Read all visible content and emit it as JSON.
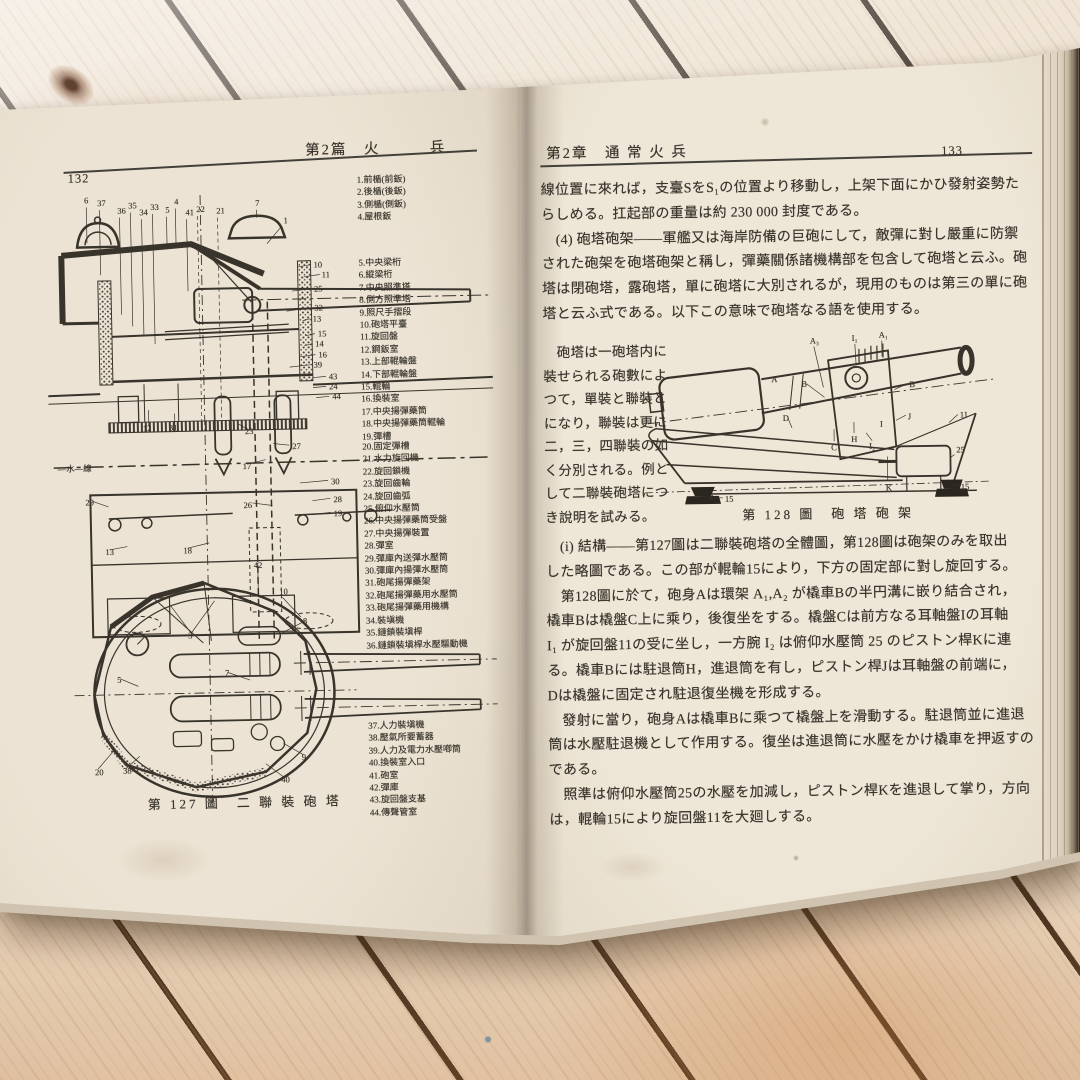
{
  "scene": {
    "description": "Open vintage Japanese gunnery textbook photographed on pale wooden planks",
    "colors": {
      "paper": "#eae1d2",
      "ink": "#38332b",
      "wood": "#ecdfcd",
      "plank_gap": "#33261b",
      "page_edge_dark": "#26201a"
    }
  },
  "book": {
    "left_page": {
      "page_number": "132",
      "running_head": "第2篇　火　　　兵",
      "figure_caption": "第 127 圖　二 聯 裝 砲 塔",
      "parts_list_1": [
        "1.前楯(前鈑)",
        "2.後楯(後鈑)",
        "3.側楯(側鈑)",
        "4.屋根鈑"
      ],
      "parts_list_2": [
        "5.中央梁桁",
        "6.縱梁桁",
        "7.中央照準塔",
        "8.側方照準塔",
        "9.照尺手摺段",
        "10.砲塔平臺",
        "11.旋回盤",
        "12.鋼鈑室",
        "13.上部輥輪盤",
        "14.下部輥輪盤",
        "15.輥輪",
        "16.換裝室",
        "17.中央揚彈藥筒",
        "18.中央揚彈藥筒輥輪",
        "19.彈槽"
      ],
      "parts_list_3": [
        "20.固定彈槽",
        "21.水力旋回機",
        "22.旋回鎖機",
        "23.旋回齒輪",
        "24.旋回齒弧",
        "25.俯仰水壓筒",
        "26.中央揚彈藥筒受盤",
        "27.中央揚彈裝置",
        "28.彈室",
        "29.彈庫內送彈水壓筒",
        "30.彈庫內揚彈水壓筒",
        "31.砲尾揚彈藥架",
        "32.砲尾揚彈藥用水壓筒",
        "33.砲尾揚彈藥用機構",
        "34.裝塡機",
        "35.鏈鎖裝塡桿",
        "36.鏈鎖裝塡桿水壓驅動機"
      ],
      "parts_list_4": [
        "37.人力裝塡機",
        "38.壓氣所要蓄器",
        "39.人力及電力水壓喞筒",
        "40.換裝室入口",
        "41.砲室",
        "42.彈庫",
        "43.旋回盤支基",
        "44.傳聲管室"
      ],
      "fig127_labels": [
        {
          "x": 40,
          "y": 28,
          "t": "6"
        },
        {
          "x": 53,
          "y": 31,
          "t": "37"
        },
        {
          "x": 73,
          "y": 39,
          "t": "36"
        },
        {
          "x": 84,
          "y": 34,
          "t": "35"
        },
        {
          "x": 95,
          "y": 41,
          "t": "34"
        },
        {
          "x": 106,
          "y": 36,
          "t": "33"
        },
        {
          "x": 121,
          "y": 39,
          "t": "5"
        },
        {
          "x": 130,
          "y": 31,
          "t": "4"
        },
        {
          "x": 141,
          "y": 42,
          "t": "41"
        },
        {
          "x": 152,
          "y": 39,
          "t": "22"
        },
        {
          "x": 172,
          "y": 41,
          "t": "21"
        },
        {
          "x": 211,
          "y": 34,
          "t": "7"
        },
        {
          "x": 239,
          "y": 52,
          "t": "1"
        },
        {
          "x": 268,
          "y": 97,
          "t": "10"
        },
        {
          "x": 276,
          "y": 107,
          "t": "11"
        },
        {
          "x": 268,
          "y": 121,
          "t": "25"
        },
        {
          "x": 268,
          "y": 140,
          "t": "32"
        },
        {
          "x": 266,
          "y": 151,
          "t": "13"
        },
        {
          "x": 271,
          "y": 166,
          "t": "15"
        },
        {
          "x": 268,
          "y": 176,
          "t": "14"
        },
        {
          "x": 271,
          "y": 187,
          "t": "16"
        },
        {
          "x": 266,
          "y": 197,
          "t": "39"
        },
        {
          "x": 281,
          "y": 209,
          "t": "43"
        },
        {
          "x": 281,
          "y": 219,
          "t": "24"
        },
        {
          "x": 284,
          "y": 229,
          "t": "44"
        },
        {
          "x": 94,
          "y": 257,
          "t": "12"
        },
        {
          "x": 120,
          "y": 257,
          "t": "31"
        },
        {
          "x": 196,
          "y": 262,
          "t": "23"
        },
        {
          "x": 243,
          "y": 278,
          "t": "27"
        },
        {
          "x": 193,
          "y": 297,
          "t": "17"
        },
        {
          "x": 35,
          "y": 330,
          "t": "29"
        },
        {
          "x": 281,
          "y": 314,
          "t": "30"
        },
        {
          "x": 283,
          "y": 332,
          "t": "28"
        },
        {
          "x": 193,
          "y": 336,
          "t": "26"
        },
        {
          "x": 283,
          "y": 346,
          "t": "19"
        },
        {
          "x": 132,
          "y": 380,
          "t": "18"
        },
        {
          "x": 54,
          "y": 380,
          "t": "13"
        },
        {
          "x": 202,
          "y": 396,
          "t": "42"
        },
        {
          "x": 8,
          "y": 296,
          "t": "―水―線",
          "s": 13
        },
        {
          "x": 227,
          "y": 423,
          "t": "10"
        },
        {
          "x": 250,
          "y": 453,
          "t": "8"
        },
        {
          "x": 135,
          "y": 465,
          "t": "3"
        },
        {
          "x": 171,
          "y": 503,
          "t": "7"
        },
        {
          "x": 63,
          "y": 508,
          "t": "5"
        },
        {
          "x": 39,
          "y": 600,
          "t": "20"
        },
        {
          "x": 67,
          "y": 599,
          "t": "38"
        },
        {
          "x": 246,
          "y": 589,
          "t": "9"
        },
        {
          "x": 225,
          "y": 611,
          "t": "40"
        }
      ]
    },
    "right_page": {
      "page_number": "133",
      "running_head": "第2章　通 常 火 兵",
      "paragraphs_top": [
        "線位置に來れば，支臺SをS₁の位置より移動し，上架下面にかひ發射姿勢た",
        "らしめる。扛起部の重量は約 230 000 封度である。",
        "　(4) 砲塔砲架――軍艦又は海岸防備の巨砲にして，敵彈に對し嚴重に防禦",
        "された砲架を砲塔砲架と稱し，彈藥關係諸機構部を包含して砲塔と云ふ。砲",
        "塔は閉砲塔，露砲塔，單に砲塔に大別されるが，現用のものは第三の單に砲",
        "塔と云ふ式である。以下この意味で砲塔なる語を使用する。"
      ],
      "sidebar_lines": [
        "　砲塔は一砲塔内に",
        "裝せられる砲數によ",
        "つて，單裝と聯裝と",
        "になり，聯裝は更に",
        "二，三，四聯裝の如",
        "く分別される。例と",
        "して二聯裝砲塔につ",
        "き說明を試みる。"
      ],
      "figure_caption": "第 128 圖　砲 塔 砲 架",
      "paragraphs_bottom": [
        "　(i) 結構――第127圖は二聯裝砲塔の全體圖，第128圖は砲架のみを取出",
        "した略圖である。この部が輥輪15により，下方の固定部に對し旋回する。",
        "　第128圖に於て，砲身Aは環架 A₁,A₂ が橇車Bの半円溝に嵌り結合され，",
        "橇車Bは橇盤C上に乘り，後復坐をする。橇盤Cは前方なる耳軸盤Iの耳軸",
        "I₁ が旋回盤11の受に坐し，一方腕 I₂ は俯仰水壓筒 25 のピストン桿Kに連",
        "る。橇車Bには駐退筒H，進退筒を有し，ピストン桿Jは耳軸盤の前端に，",
        "Dは橇盤に固定され駐退復坐機を形成する。",
        "　發射に當り，砲身Aは橇車Bに乘つて橇盤上を滑動する。駐退筒並に進退",
        "筒は水壓駐退機として作用する。復坐は進退筒に水壓をかけ橇車を押返すの",
        "である。",
        "　照準は俯仰水壓筒25の水壓を加減し，ピストン桿Kを進退して掌り，方向",
        "は，輥輪15により旋回盤11を大廻しする。"
      ],
      "fig128_labels": [
        {
          "x": 167,
          "y": 14,
          "t": "A₃"
        },
        {
          "x": 209,
          "y": 12,
          "t": "I₁"
        },
        {
          "x": 236,
          "y": 9,
          "t": "A₁"
        },
        {
          "x": 128,
          "y": 52,
          "t": "A",
          "s": 11
        },
        {
          "x": 158,
          "y": 57,
          "t": "B",
          "s": 10
        },
        {
          "x": 266,
          "y": 59,
          "t": "B",
          "s": 10
        },
        {
          "x": 139,
          "y": 91,
          "t": "D",
          "s": 10
        },
        {
          "x": 187,
          "y": 121,
          "t": "C",
          "s": 10
        },
        {
          "x": 207,
          "y": 113,
          "t": "H",
          "s": 10
        },
        {
          "x": 236,
          "y": 98,
          "t": "I",
          "s": 11
        },
        {
          "x": 225,
          "y": 120,
          "t": "I₂"
        },
        {
          "x": 264,
          "y": 91,
          "t": "J",
          "s": 10
        },
        {
          "x": 241,
          "y": 162,
          "t": "K",
          "s": 10
        },
        {
          "x": 316,
          "y": 90,
          "t": "11"
        },
        {
          "x": 312,
          "y": 125,
          "t": "25"
        },
        {
          "x": 80,
          "y": 171,
          "t": "15"
        },
        {
          "x": 316,
          "y": 162,
          "t": "15"
        }
      ]
    }
  }
}
